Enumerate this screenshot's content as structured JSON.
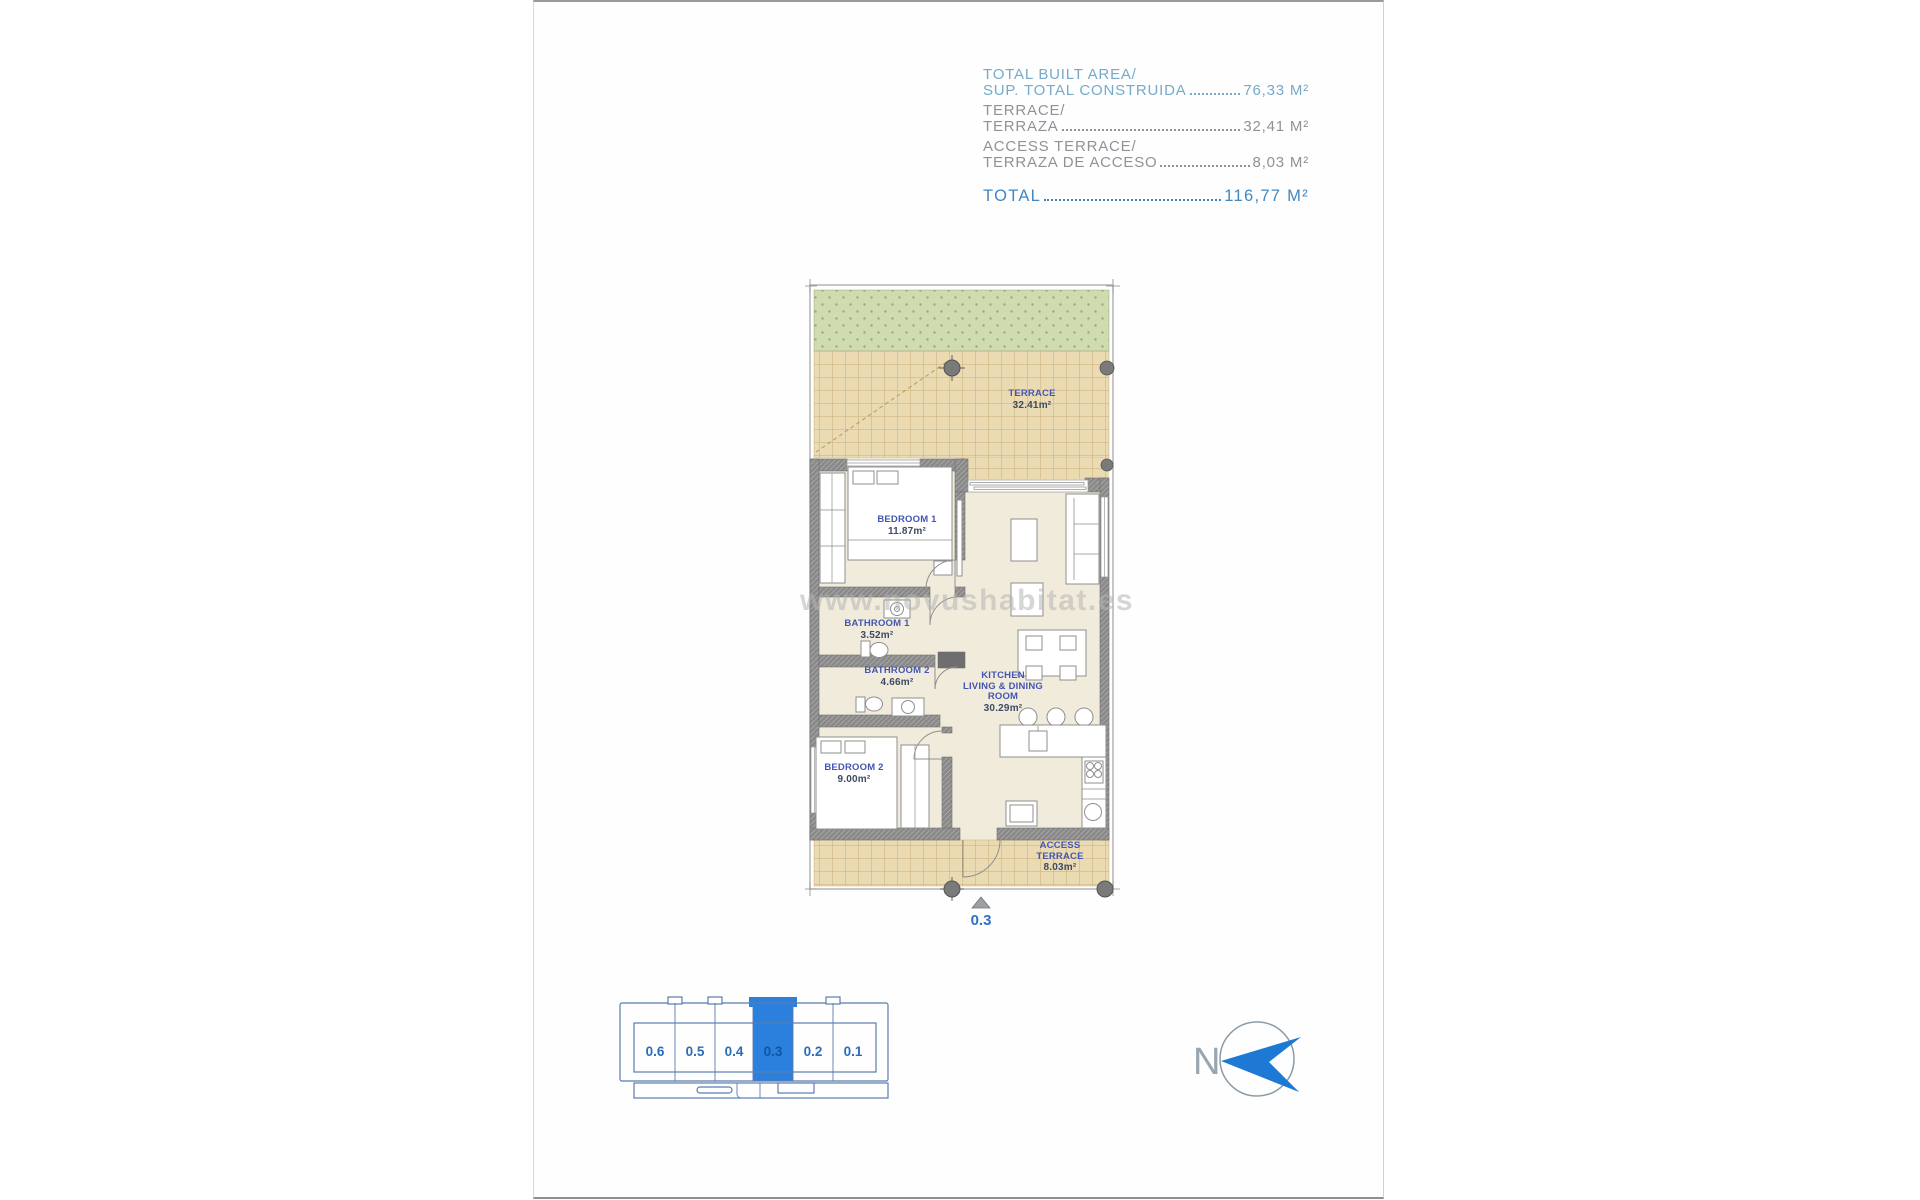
{
  "page": {
    "watermark": "www.novushabitat.es"
  },
  "area_summary": {
    "rows": [
      {
        "line1": "TOTAL BUILT AREA/",
        "line2": "SUP. TOTAL CONSTRUIDA",
        "value": "76,33 M²"
      },
      {
        "line1": "TERRACE/",
        "line2": "TERRAZA",
        "value": "32,41 M²"
      },
      {
        "line1": "ACCESS TERRACE/",
        "line2": "TERRAZA DE ACCESO",
        "value": "8,03 M²"
      }
    ],
    "total_label": "TOTAL",
    "total_value": "116,77 M²"
  },
  "floorplan": {
    "rooms": {
      "terrace": {
        "name": "TERRACE",
        "area": "32.41m²"
      },
      "bedroom1": {
        "name": "BEDROOM 1",
        "area": "11.87m²"
      },
      "bathroom1": {
        "name": "BATHROOM 1",
        "area": "3.52m²"
      },
      "bathroom2": {
        "name": "BATHROOM 2",
        "area": "4.66m²"
      },
      "bedroom2": {
        "name": "BEDROOM 2",
        "area": "9.00m²"
      },
      "kitchen": {
        "name_line1": "KITCHEN",
        "name_line2": "LIVING & DINING",
        "name_line3": "ROOM",
        "area": "30.29m²"
      },
      "access_terrace": {
        "name_line1": "ACCESS",
        "name_line2": "TERRACE",
        "area": "8.03m²"
      }
    },
    "unit_marker": "0.3"
  },
  "locator": {
    "units": [
      {
        "label": "0.6"
      },
      {
        "label": "0.5"
      },
      {
        "label": "0.4"
      },
      {
        "label": "0.3"
      },
      {
        "label": "0.2"
      },
      {
        "label": "0.1"
      }
    ],
    "selected_unit": "0.3"
  },
  "compass": {
    "north_label": "N"
  },
  "colors": {
    "highlight_blue": "#2a80dc",
    "summary_light_blue": "#75aac9",
    "summary_gray": "#8e9398",
    "summary_total_blue": "#4187c1",
    "room_label_blue": "#4356b2",
    "compass_arrow_blue": "#1d79d3"
  }
}
